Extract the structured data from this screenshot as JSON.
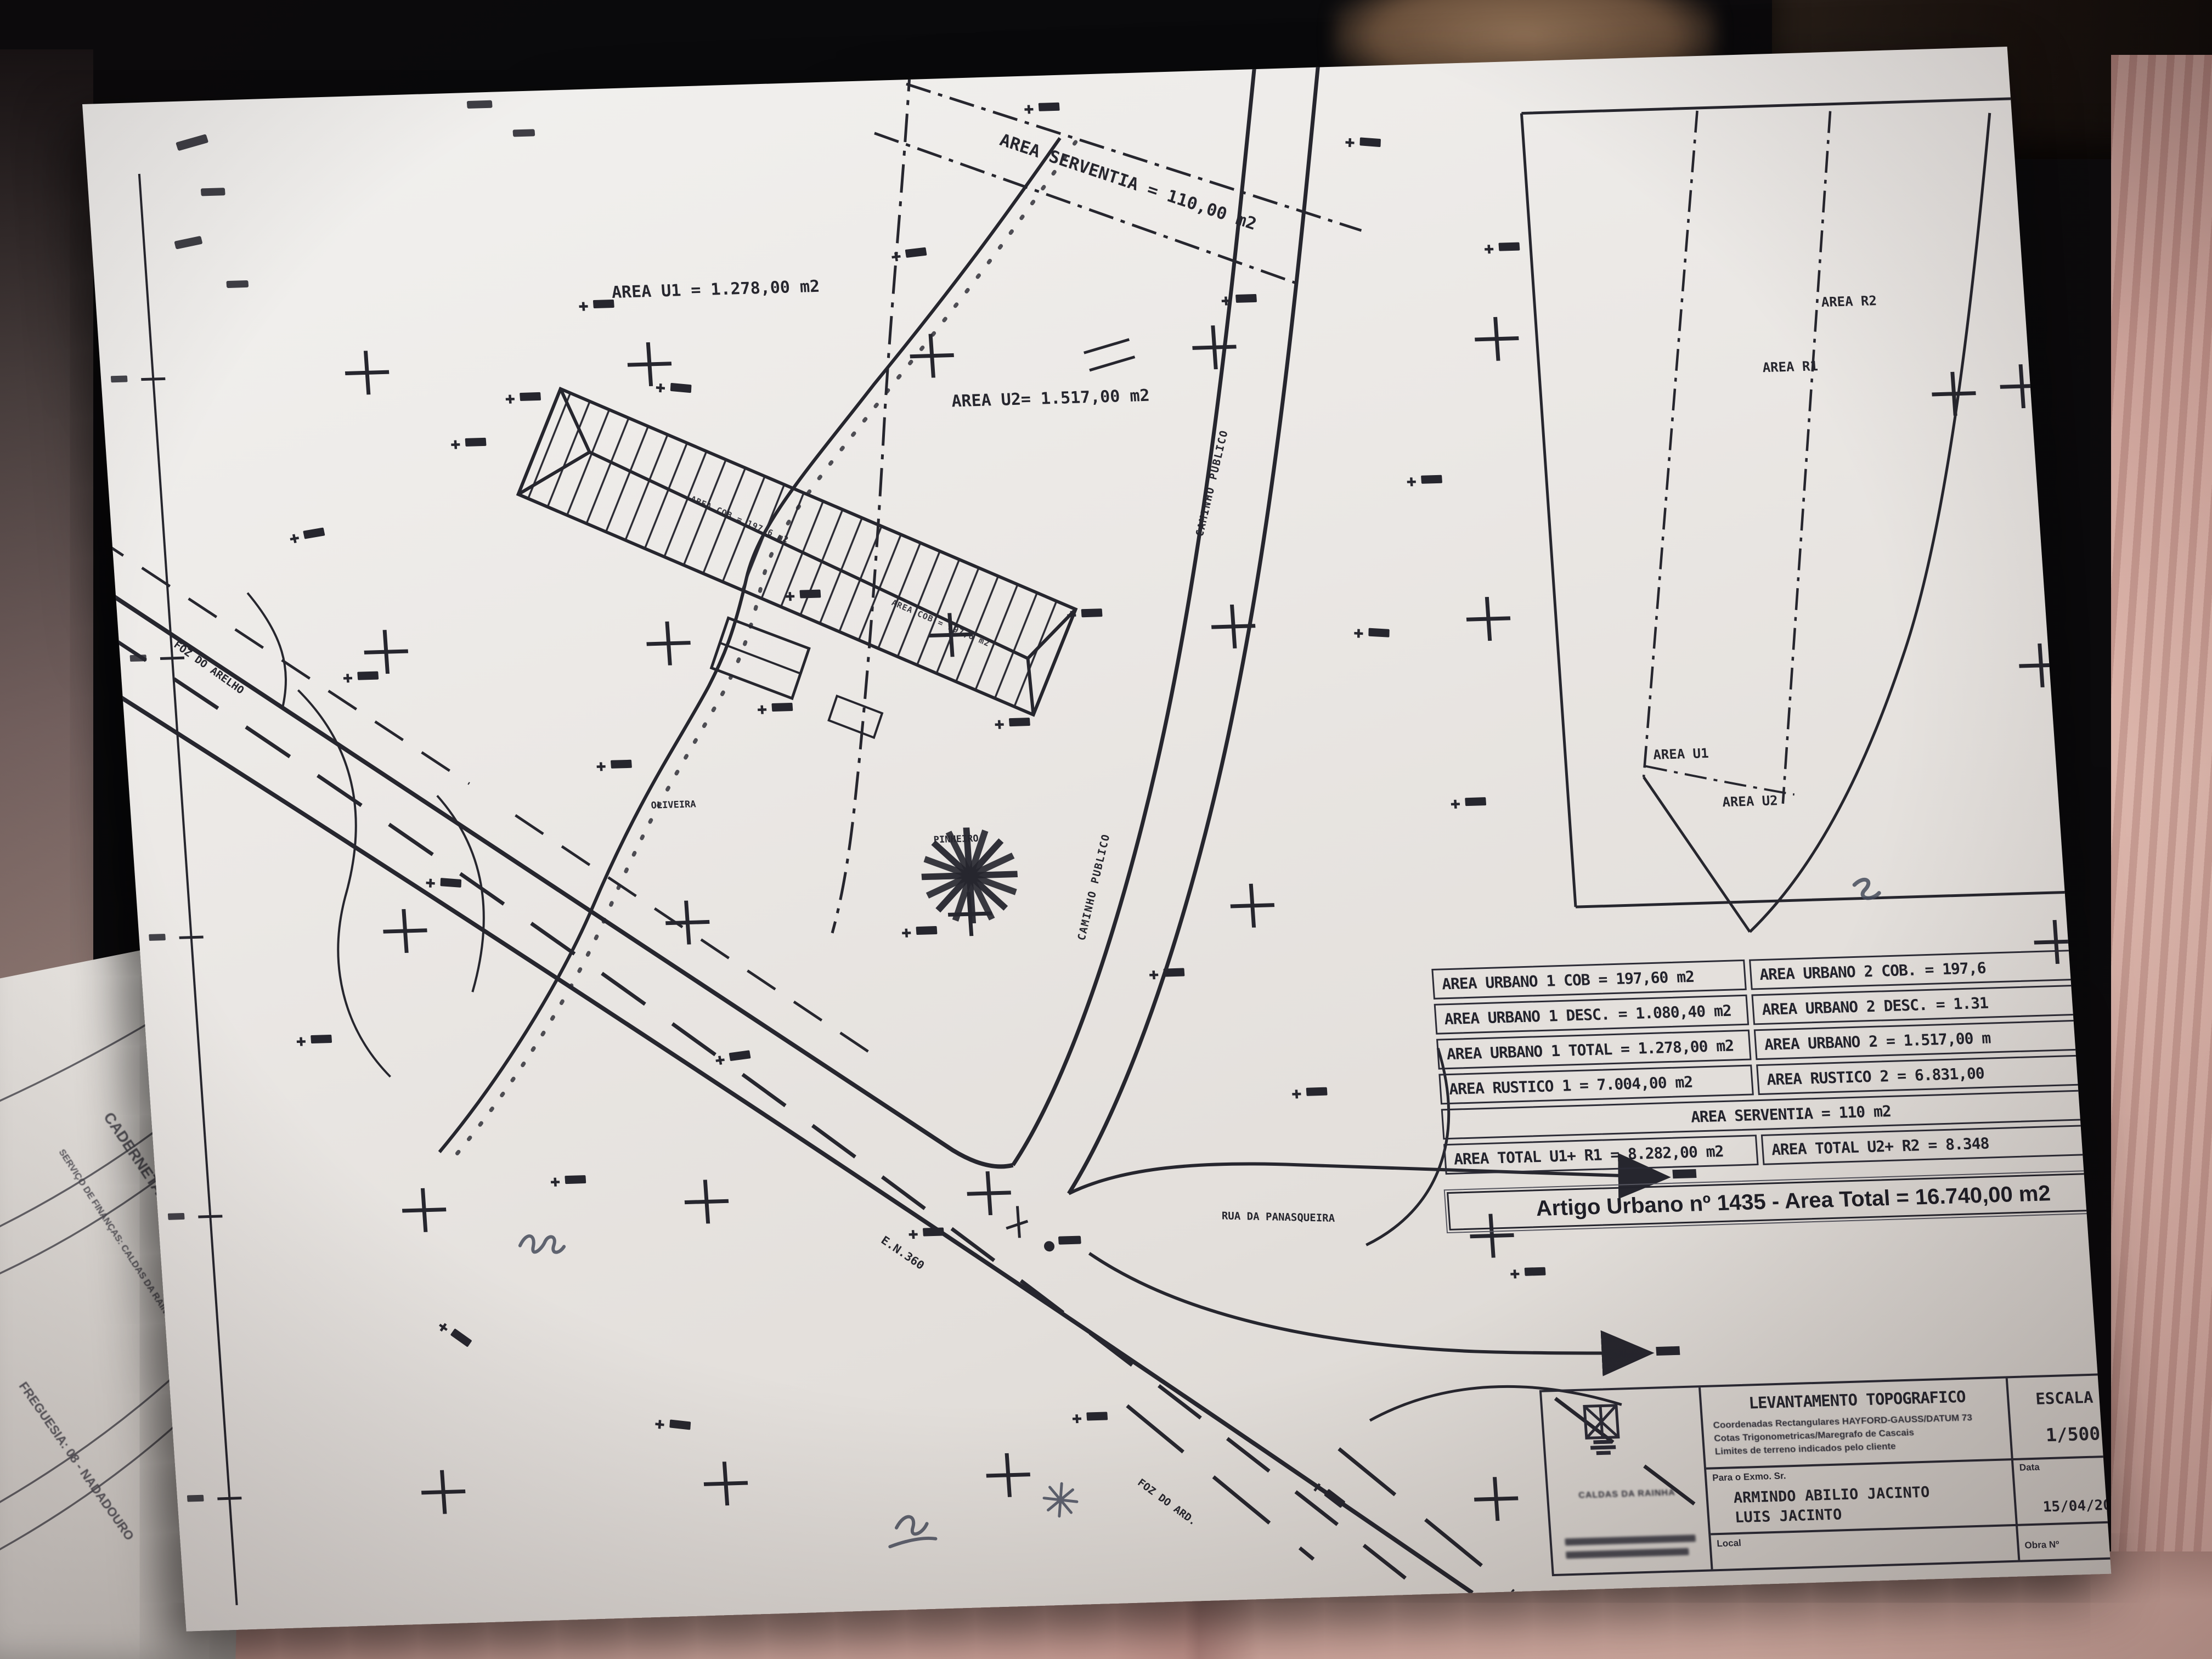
{
  "plan": {
    "area_labels": {
      "serventia": "AREA SERVENTIA = 110,00 m2",
      "u1": "AREA U1 = 1.278,00 m2",
      "u2": "AREA U2= 1.517,00 m2"
    },
    "feature_labels": {
      "oliveira": "OLIVEIRA",
      "pinheiro": "PINHEIRO",
      "caminho_publico_upper": "CAMINHO PUBLICO",
      "caminho_publico_lower": "CAMINHO PUBLICO",
      "rua_panasqueira": "RUA DA PANASQUEIRA",
      "en360": "E.N.360",
      "foz_upper": "FOZ DO ARELHO",
      "foz_lower": "FOZ DO ARD.",
      "building_ridge_1": "AREA COB = 197,6 m2",
      "building_ridge_2": "AREA COB = 197,6 m2"
    }
  },
  "side_panel": {
    "r2": "AREA R2",
    "r1": "AREA R1",
    "u1": "AREA U1",
    "u2": "AREA U2"
  },
  "summary_table": {
    "col1": [
      "AREA URBANO 1 COB = 197,60 m2",
      "AREA URBANO 1 DESC. = 1.080,40 m2",
      "AREA URBANO 1 TOTAL = 1.278,00 m2",
      "AREA RUSTICO 1 = 7.004,00 m2"
    ],
    "col2": [
      "AREA URBANO 2 COB. = 197,6",
      "AREA URBANO 2 DESC. = 1.31",
      "AREA URBANO 2 = 1.517,00 m",
      "AREA RUSTICO 2 = 6.831,00"
    ],
    "serventia_row": "AREA SERVENTIA = 110 m2",
    "total1": "AREA TOTAL U1+ R1 = 8.282,00 m2",
    "total2": "AREA TOTAL U2+ R2 = 8.348",
    "banner": "Artigo Urbano nº 1435 - Area Total = 16.740,00 m2"
  },
  "title_block": {
    "title": "LEVANTAMENTO TOPOGRAFICO",
    "subtitle_lines": [
      "Coordenadas Rectangulares HAYFORD-GAUSS/DATUM 73",
      "Cotas Trigonometricas/Maregrafo de Cascais",
      "Limites de terreno indicados pelo cliente"
    ],
    "scale_label": "ESCALA",
    "scale_value": "1/500",
    "client_label": "Para o Exmo. Sr.",
    "client_name_1": "ARMINDO ABILIO JACINTO",
    "client_name_2": "LUIS JACINTO",
    "date_label": "Data",
    "date_value": "15/04/20",
    "local_label": "Local",
    "obra_label": "Obra Nº",
    "company_location": "CALDAS DA RAINHA"
  },
  "under_document": {
    "line1": "CADERNETA PREDIAL UR",
    "line2": "SERVIÇO DE FINANÇAS: CALDAS DA RAINHA",
    "line3": "FREGUESIA: 08 - NADADOURO"
  }
}
